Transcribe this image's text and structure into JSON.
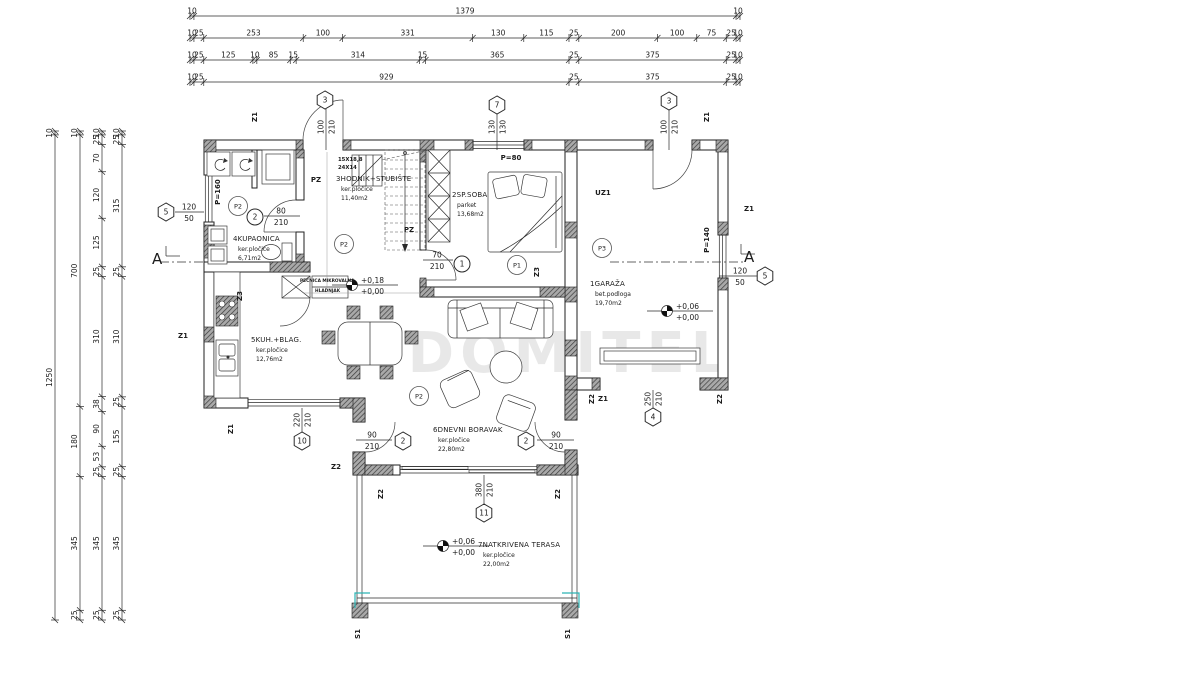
{
  "watermark": "DOMITEL",
  "section": {
    "label": "A"
  },
  "stair_note": [
    "15X18,8",
    "24X14"
  ],
  "mini_labels": [
    {
      "t": "PEĆNICA MIKROVALNA",
      "x": 300,
      "y": 282
    },
    {
      "t": "HLADNJAK",
      "x": 315,
      "y": 292
    }
  ],
  "rooms": [
    {
      "name": "1GARAŽA",
      "material": "bet.podloga",
      "area": "19,70m2",
      "x": 590,
      "y": 286
    },
    {
      "name": "2SP.SOBA",
      "material": "parket",
      "area": "13,68m2",
      "x": 452,
      "y": 197
    },
    {
      "name": "3HODNIK+STUBIŠTE",
      "material": "ker.pločice",
      "area": "11,40m2",
      "x": 336,
      "y": 181
    },
    {
      "name": "4KUPAONICA",
      "material": "ker.pločice",
      "area": "6,71m2",
      "x": 233,
      "y": 241
    },
    {
      "name": "5KUH.+BLAG.",
      "material": "ker.pločice",
      "area": "12,76m2",
      "x": 251,
      "y": 342
    },
    {
      "name": "6DNEVNI BORAVAK",
      "material": "ker.pločice",
      "area": "22,80m2",
      "x": 433,
      "y": 432
    },
    {
      "name": "7NATKRIVENA TERASA",
      "material": "ker.pločice",
      "area": "22,00m2",
      "x": 478,
      "y": 547
    }
  ],
  "levels": [
    {
      "a": "+0,18",
      "b": "+0,00",
      "x": 352,
      "y": 285
    },
    {
      "a": "+0,06",
      "b": "+0,00",
      "x": 667,
      "y": 311
    },
    {
      "a": "+0,06",
      "b": "+0,00",
      "x": 443,
      "y": 546
    }
  ],
  "hex_markers": [
    {
      "n": "3",
      "x": 325,
      "y": 100
    },
    {
      "n": "7",
      "x": 497,
      "y": 105
    },
    {
      "n": "3",
      "x": 669,
      "y": 101
    },
    {
      "n": "5",
      "x": 166,
      "y": 212
    },
    {
      "n": "5",
      "x": 765,
      "y": 276
    },
    {
      "n": "10",
      "x": 302,
      "y": 441
    },
    {
      "n": "11",
      "x": 484,
      "y": 513
    },
    {
      "n": "4",
      "x": 653,
      "y": 417
    },
    {
      "n": "2",
      "x": 403,
      "y": 441
    },
    {
      "n": "2",
      "x": 526,
      "y": 441
    }
  ],
  "circle_markers": [
    {
      "n": "2",
      "x": 255,
      "y": 217
    },
    {
      "n": "1",
      "x": 462,
      "y": 264
    }
  ],
  "floor_tags": [
    {
      "t": "P2",
      "x": 238,
      "y": 206
    },
    {
      "t": "P2",
      "x": 344,
      "y": 244
    },
    {
      "t": "P2",
      "x": 419,
      "y": 396
    },
    {
      "t": "P1",
      "x": 517,
      "y": 265
    },
    {
      "t": "P3",
      "x": 602,
      "y": 248
    }
  ],
  "wall_tags": [
    {
      "t": "Z1",
      "x": 257,
      "y": 117,
      "rot": 1
    },
    {
      "t": "Z1",
      "x": 709,
      "y": 117,
      "rot": 1
    },
    {
      "t": "Z1",
      "x": 749,
      "y": 211,
      "rot": 0
    },
    {
      "t": "Z1",
      "x": 183,
      "y": 338,
      "rot": 0
    },
    {
      "t": "Z1",
      "x": 233,
      "y": 429,
      "rot": 1
    },
    {
      "t": "Z1",
      "x": 603,
      "y": 401,
      "rot": 0
    },
    {
      "t": "Z2",
      "x": 336,
      "y": 469,
      "rot": 0
    },
    {
      "t": "Z2",
      "x": 594,
      "y": 399,
      "rot": 1
    },
    {
      "t": "Z2",
      "x": 722,
      "y": 399,
      "rot": 1
    },
    {
      "t": "Z2",
      "x": 383,
      "y": 494,
      "rot": 1
    },
    {
      "t": "Z2",
      "x": 560,
      "y": 494,
      "rot": 1
    },
    {
      "t": "Z3",
      "x": 242,
      "y": 296,
      "rot": 1
    },
    {
      "t": "Z3",
      "x": 539,
      "y": 272,
      "rot": 1
    },
    {
      "t": "S1",
      "x": 360,
      "y": 634,
      "rot": 1
    },
    {
      "t": "S1",
      "x": 570,
      "y": 634,
      "rot": 1
    },
    {
      "t": "PZ",
      "x": 316,
      "y": 182,
      "rot": 0
    },
    {
      "t": "PZ",
      "x": 409,
      "y": 232,
      "rot": 0
    },
    {
      "t": "UZ1",
      "x": 603,
      "y": 195,
      "rot": 0
    },
    {
      "t": "P=80",
      "x": 511,
      "y": 160,
      "rot": 0
    },
    {
      "t": "P=160",
      "x": 220,
      "y": 192,
      "rot": 1
    },
    {
      "t": "P=140",
      "x": 709,
      "y": 240,
      "rot": 1
    }
  ],
  "door_fracs": [
    {
      "a": "80",
      "b": "210",
      "x": 281,
      "y": 216,
      "lx1": 264,
      "lx2": 300
    },
    {
      "a": "70",
      "b": "210",
      "x": 437,
      "y": 260,
      "lx1": 423,
      "lx2": 453
    },
    {
      "a": "90",
      "b": "210",
      "x": 372,
      "y": 440,
      "lx1": 356,
      "lx2": 392
    },
    {
      "a": "90",
      "b": "210",
      "x": 556,
      "y": 440,
      "lx1": 537,
      "lx2": 574
    },
    {
      "a": "120",
      "b": "50",
      "x": 189,
      "y": 212,
      "lx1": 175,
      "lx2": 204
    },
    {
      "a": "120",
      "b": "50",
      "x": 740,
      "y": 276,
      "lx1": 719,
      "lx2": 757
    }
  ],
  "rot_dims": [
    {
      "a": "100",
      "b": "210",
      "x": 326,
      "y": 127,
      "ly1": 109,
      "ly2": 150
    },
    {
      "a": "130",
      "b": "130",
      "x": 497,
      "y": 127,
      "ly1": 114,
      "ly2": 150
    },
    {
      "a": "100",
      "b": "210",
      "x": 669,
      "y": 127,
      "ly1": 110,
      "ly2": 150
    },
    {
      "a": "220",
      "b": "210",
      "x": 302,
      "y": 420,
      "ly1": 408,
      "ly2": 432
    },
    {
      "a": "380",
      "b": "210",
      "x": 484,
      "y": 490,
      "ly1": 475,
      "ly2": 504
    },
    {
      "a": "250",
      "b": "210",
      "x": 653,
      "y": 399,
      "ly1": 390,
      "ly2": 408
    }
  ],
  "dims_top": {
    "x0": 190,
    "x1": 740,
    "rows": [
      {
        "y": 16,
        "segs": [
          "10",
          "1379",
          "10"
        ]
      },
      {
        "y": 38,
        "segs": [
          "10",
          "25",
          "253",
          "100",
          "331",
          "130",
          "115",
          "25",
          "200",
          "100",
          "75",
          "25",
          "10"
        ]
      },
      {
        "y": 60,
        "segs": [
          "10",
          "25",
          "125",
          "10",
          "85",
          "15",
          "314",
          "15",
          "365",
          "25",
          "375",
          "25",
          "10"
        ]
      },
      {
        "y": 82,
        "segs": [
          "10",
          "25",
          "929",
          "25",
          "375",
          "25",
          "10"
        ]
      }
    ]
  },
  "dims_left": {
    "y0": 131,
    "y1": 620,
    "cols": [
      {
        "x": 55,
        "segs": [
          "10",
          "1250"
        ]
      },
      {
        "x": 80,
        "segs": [
          "10",
          "700",
          "180",
          "345",
          "25"
        ]
      },
      {
        "x": 102,
        "segs": [
          "10",
          "25",
          "70",
          "120",
          "125",
          "25",
          "310",
          "38",
          "90",
          "53",
          "25",
          "345",
          "25"
        ]
      },
      {
        "x": 122,
        "segs": [
          "10",
          "25",
          "315",
          "25",
          "310",
          "25",
          "155",
          "25",
          "345",
          "25"
        ]
      }
    ]
  }
}
